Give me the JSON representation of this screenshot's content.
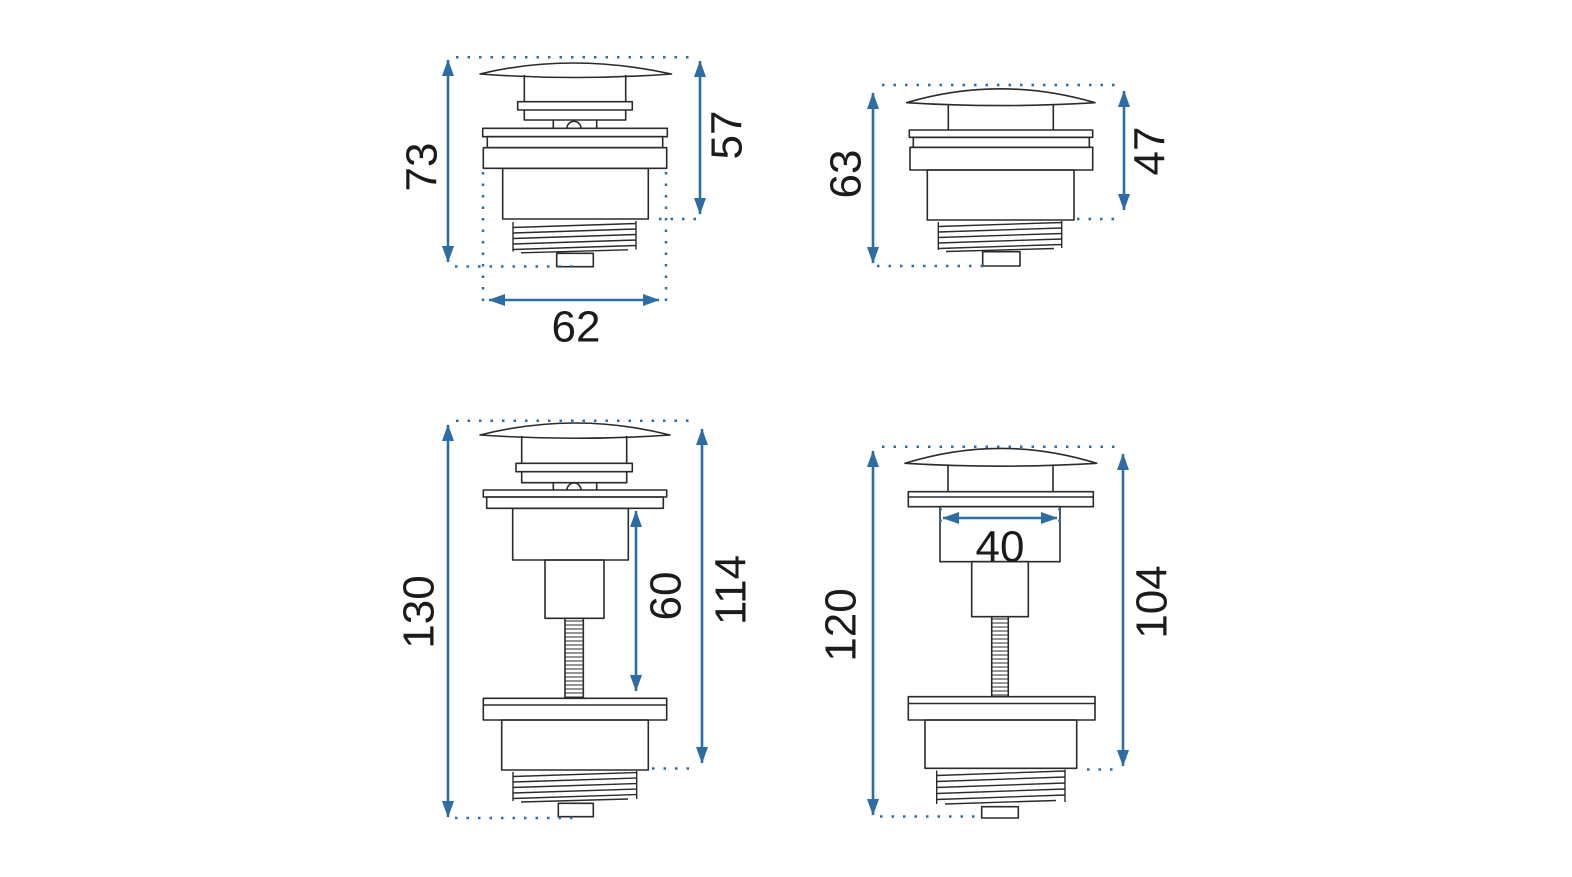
{
  "colors": {
    "dimension_blue": "#2e6da4",
    "outline_dark": "#2b2b2b",
    "label_black": "#1b1b1b",
    "background": "#ffffff"
  },
  "diagrams": {
    "top_left": {
      "height_total": "73",
      "height_body": "57",
      "width_total": "62"
    },
    "top_right": {
      "height_total": "63",
      "height_body": "47"
    },
    "bottom_left": {
      "height_total": "130",
      "rod_length": "60",
      "height_body": "114"
    },
    "bottom_right": {
      "height_total": "120",
      "cap_width": "40",
      "height_body": "104"
    }
  }
}
